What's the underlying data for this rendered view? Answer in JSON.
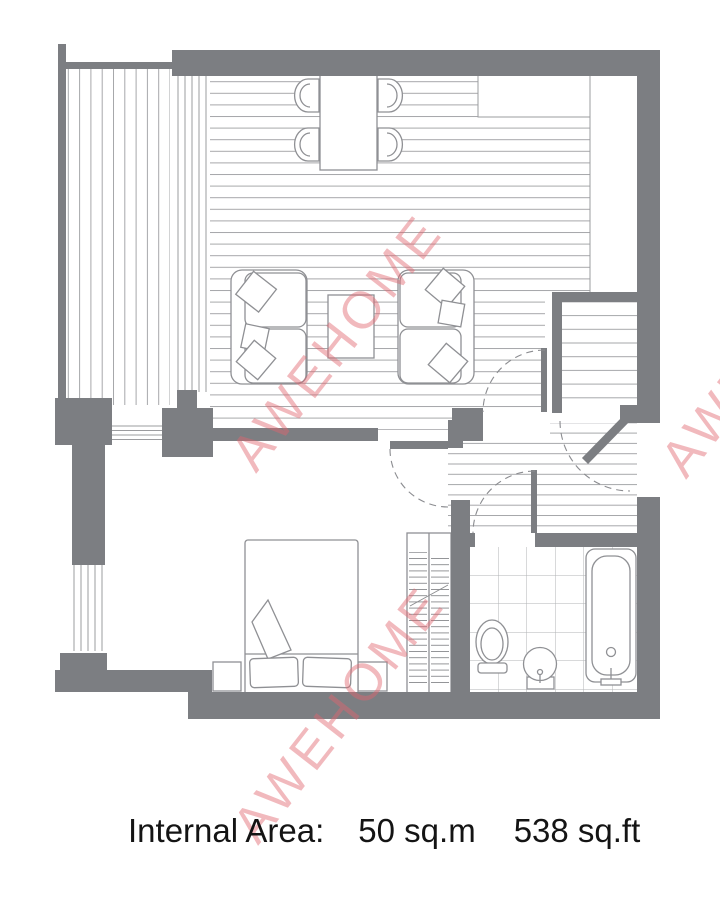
{
  "footer": {
    "label": "Internal Area:",
    "metric": "50 sq.m",
    "imperial": "538 sq.ft"
  },
  "watermark": {
    "text": "AWEHOME",
    "color": "#e2656f",
    "opacity": 0.45
  },
  "colors": {
    "wall": "#7c7e82",
    "floor_line": "#a6a7aa",
    "tile_line": "#b2b3b6",
    "outline": "#8f9094",
    "background": "#ffffff",
    "text": "#141414"
  }
}
